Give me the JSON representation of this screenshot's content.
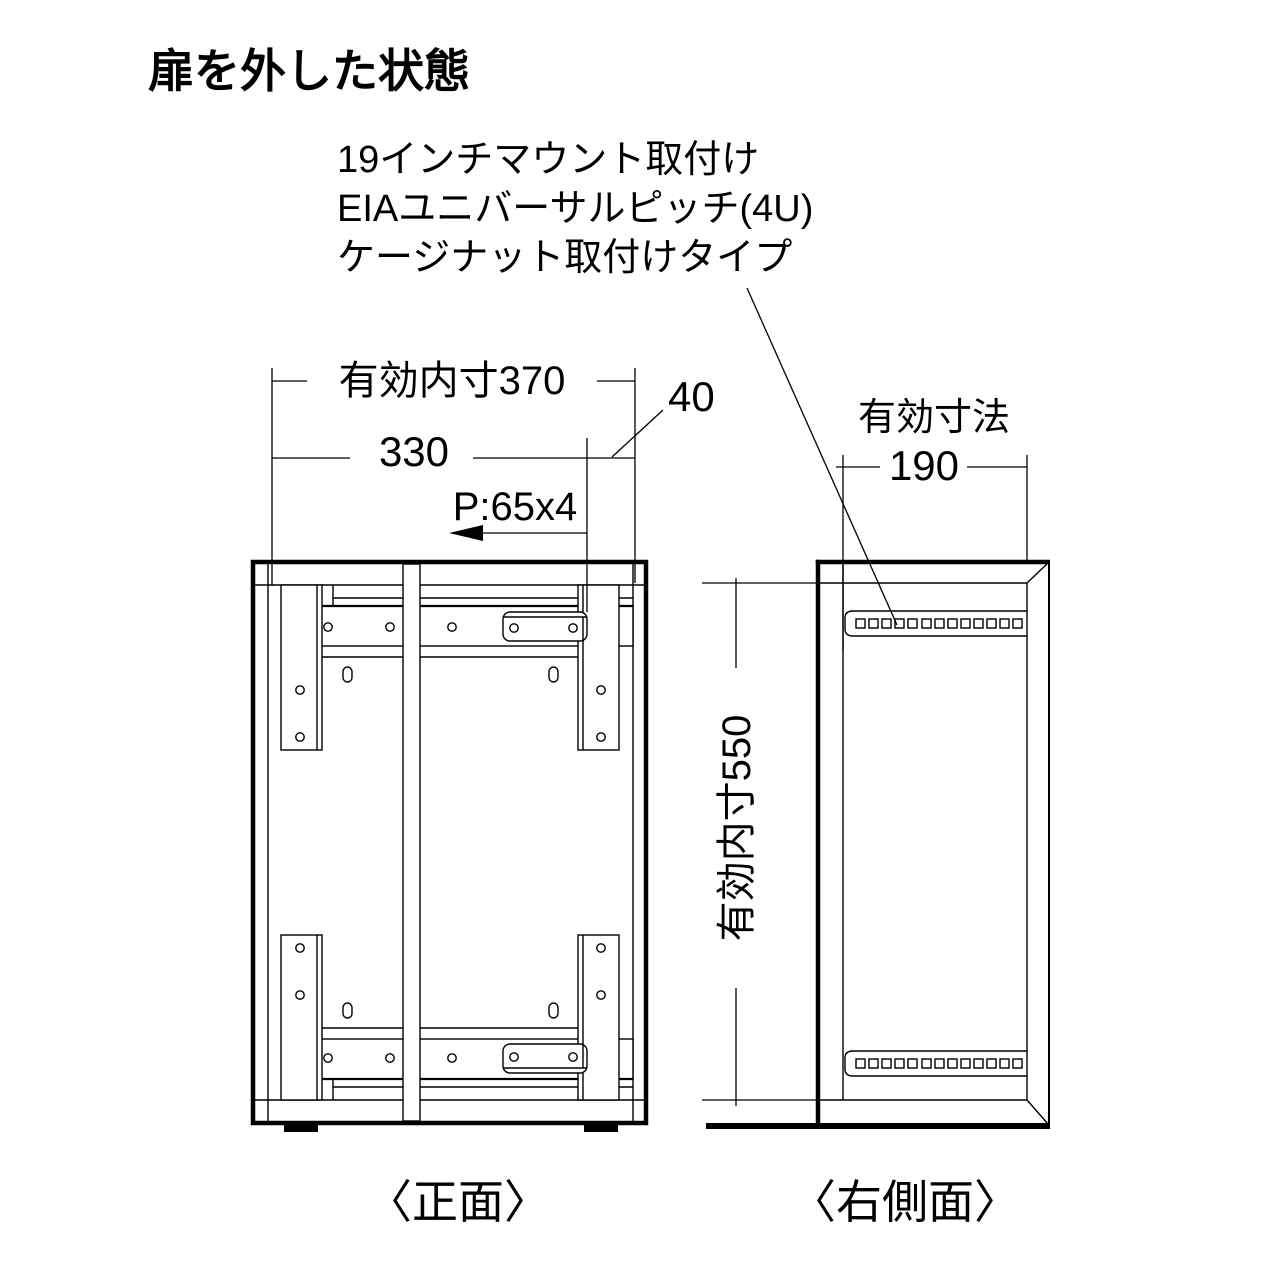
{
  "colors": {
    "background": "#ffffff",
    "line": "#000000"
  },
  "title": "扉を外した状態",
  "annotation": {
    "lines": [
      "19インチマウント取付け",
      "EIAユニバーサルピッチ(4U)",
      "ケージナット取付けタイプ"
    ]
  },
  "front_view": {
    "caption": "〈正面〉",
    "dims": {
      "inner_width": "有効内寸370",
      "mount_width": "330",
      "offset": "40",
      "hole_pitch": "P:65x4",
      "inner_height": "有効内寸550"
    }
  },
  "side_view": {
    "caption": "〈右側面〉",
    "dims": {
      "label": "有効寸法",
      "depth": "190"
    }
  }
}
